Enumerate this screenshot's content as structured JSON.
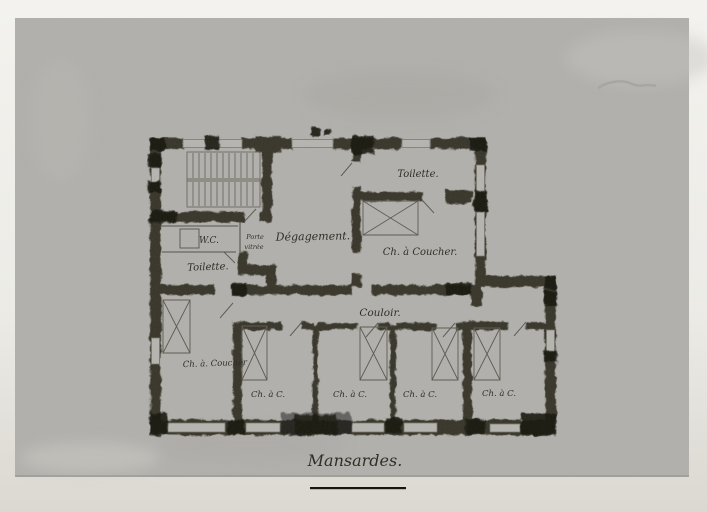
{
  "plan": {
    "title": "Mansardes.",
    "rooms": {
      "wc": "W.C.",
      "door_note_line1": "Porte",
      "door_note_line2": "vitrée",
      "toilette_back": "Toilette.",
      "degagement": "Dégagement.",
      "toilette_front": "Toilette.",
      "bedroom_large": "Ch. à Coucher.",
      "corridor": "Couloir.",
      "bedroom_left": "Ch. à. Coucher",
      "small_bedrooms": [
        "Ch. à C.",
        "Ch. à C.",
        "Ch. à C.",
        "Ch. à C."
      ]
    },
    "colors": {
      "page": "#eeede9",
      "paper": "#b2b1ad",
      "wall": "#38342c",
      "ink": "#2e2a23"
    }
  }
}
